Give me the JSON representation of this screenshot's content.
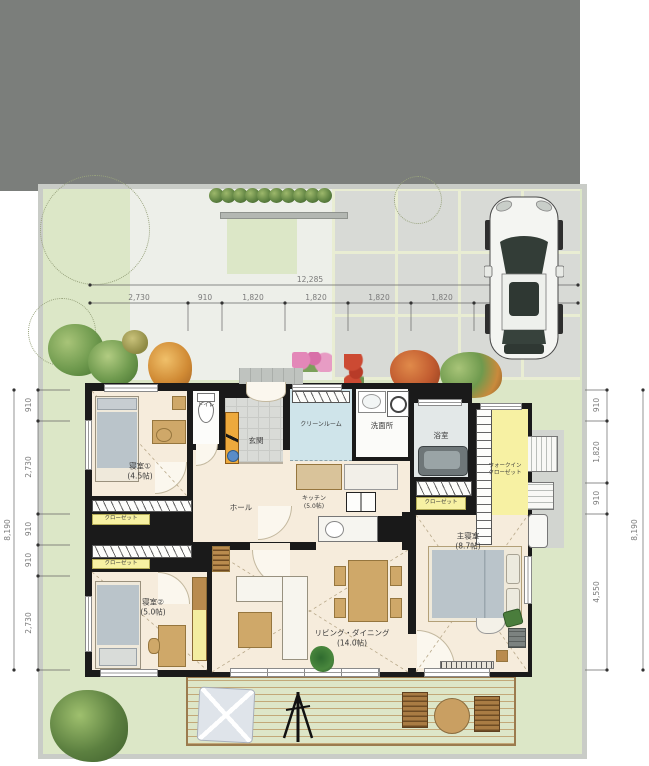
{
  "dims": {
    "top": {
      "overall": "12,285",
      "segments": [
        "2,730",
        "910",
        "1,820",
        "1,820",
        "1,820",
        "1,820",
        "1,365"
      ]
    },
    "left": {
      "overall": "8,190",
      "segments": [
        "910",
        "2,730",
        "910",
        "910",
        "2,730"
      ]
    },
    "right": {
      "overall": "8,190",
      "segments": [
        "910",
        "1,820",
        "910",
        "4,550"
      ]
    }
  },
  "rooms": {
    "bedroom1": {
      "name": "寝室①",
      "size": "(4.5帖)"
    },
    "bedroom2": {
      "name": "寝室②",
      "size": "(5.0帖)"
    },
    "master": {
      "name": "主寝室",
      "size": "(8.7帖)"
    },
    "living": {
      "name": "リビング・ダイニング",
      "size": "(14.0帖)"
    },
    "kitchen": {
      "name": "キッチン",
      "size": "(5.0帖)"
    },
    "entrance": {
      "name": "玄関"
    },
    "hall": {
      "name": "ホール"
    },
    "toilet": {
      "name": "トイレ"
    },
    "cleanroom": {
      "name": "クリーンルーム"
    },
    "washroom": {
      "name": "洗面所"
    },
    "bathroom": {
      "name": "浴室"
    },
    "wic": {
      "line1": "ウォークイン",
      "line2": "クローゼット"
    },
    "closet_bedroom1": {
      "name": "クローゼット"
    },
    "closet_bedroom2": {
      "name": "クローゼット"
    },
    "closet_master": {
      "name": "クローゼット"
    }
  },
  "colors": {
    "wall": "#1a1a1a",
    "floor": "#f6ecdc",
    "lawn": "#dce7c7",
    "closet_yellow": "#f7f1a3",
    "wet_blue": "#cfe4ea",
    "road_grey": "#7b7e7b",
    "wood": "#c99f62",
    "tile": "#d8dad6"
  }
}
